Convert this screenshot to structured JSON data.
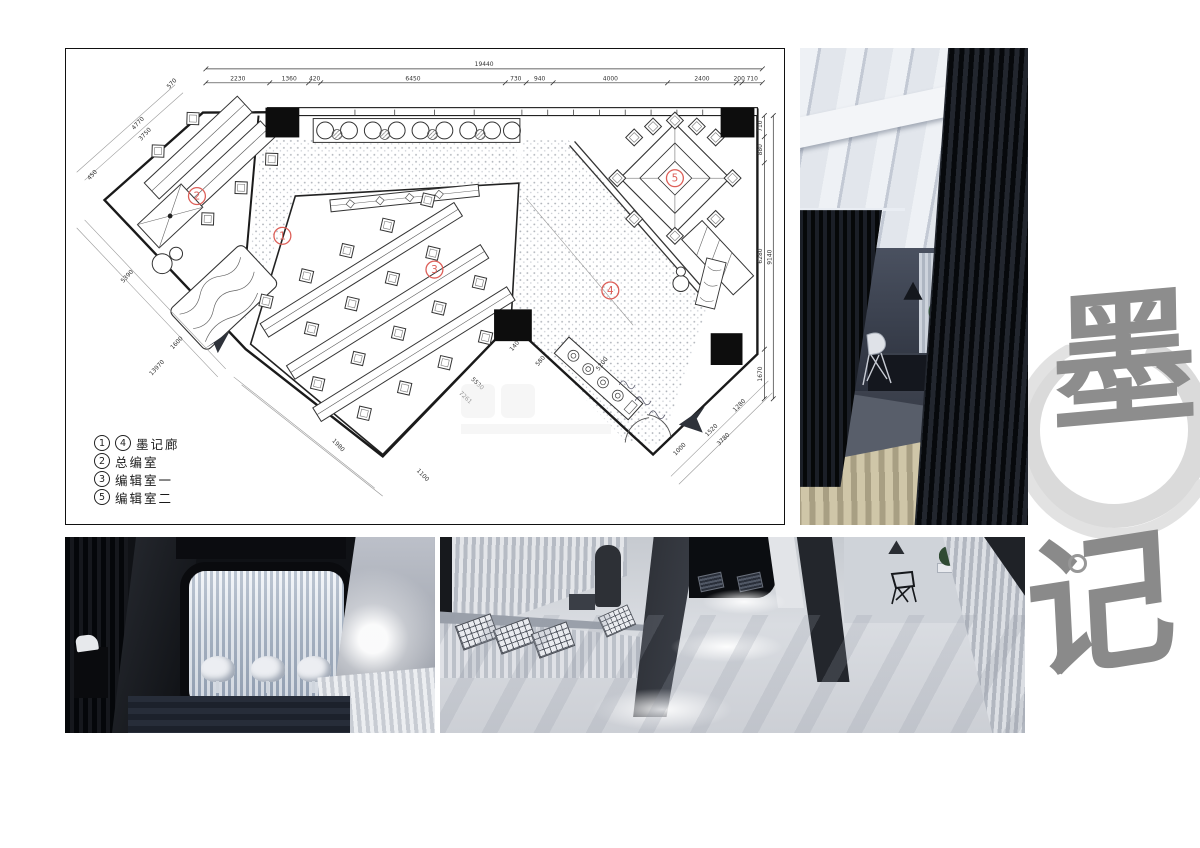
{
  "plan": {
    "accent_red": "#dd5f58",
    "wall_color": "#1a1a1a",
    "rooms": [
      "1",
      "2",
      "3",
      "4",
      "5"
    ],
    "legend": [
      {
        "markers": [
          "1",
          "4"
        ],
        "label": "墨记廊"
      },
      {
        "markers": [
          "2"
        ],
        "label": "总编室"
      },
      {
        "markers": [
          "3"
        ],
        "label": "编辑室一"
      },
      {
        "markers": [
          "5"
        ],
        "label": "编辑室二"
      }
    ],
    "dims": {
      "top_total": "19440",
      "top": [
        "2230",
        "1360",
        "420",
        "6450",
        "730",
        "940",
        "4000",
        "2400",
        "200",
        "710"
      ],
      "right": [
        "710",
        "880",
        "6280",
        "1670"
      ],
      "right_total": "9140",
      "left": [
        "570",
        "4770",
        "3750",
        "450",
        "5390",
        "1600",
        "13970"
      ],
      "bottom": [
        "1980",
        "1100",
        "5530",
        "7261",
        "140",
        "580",
        "5200",
        "1000",
        "1520",
        "3780",
        "1280"
      ]
    }
  },
  "logo": {
    "char_top": "墨",
    "char_bottom": "记"
  }
}
